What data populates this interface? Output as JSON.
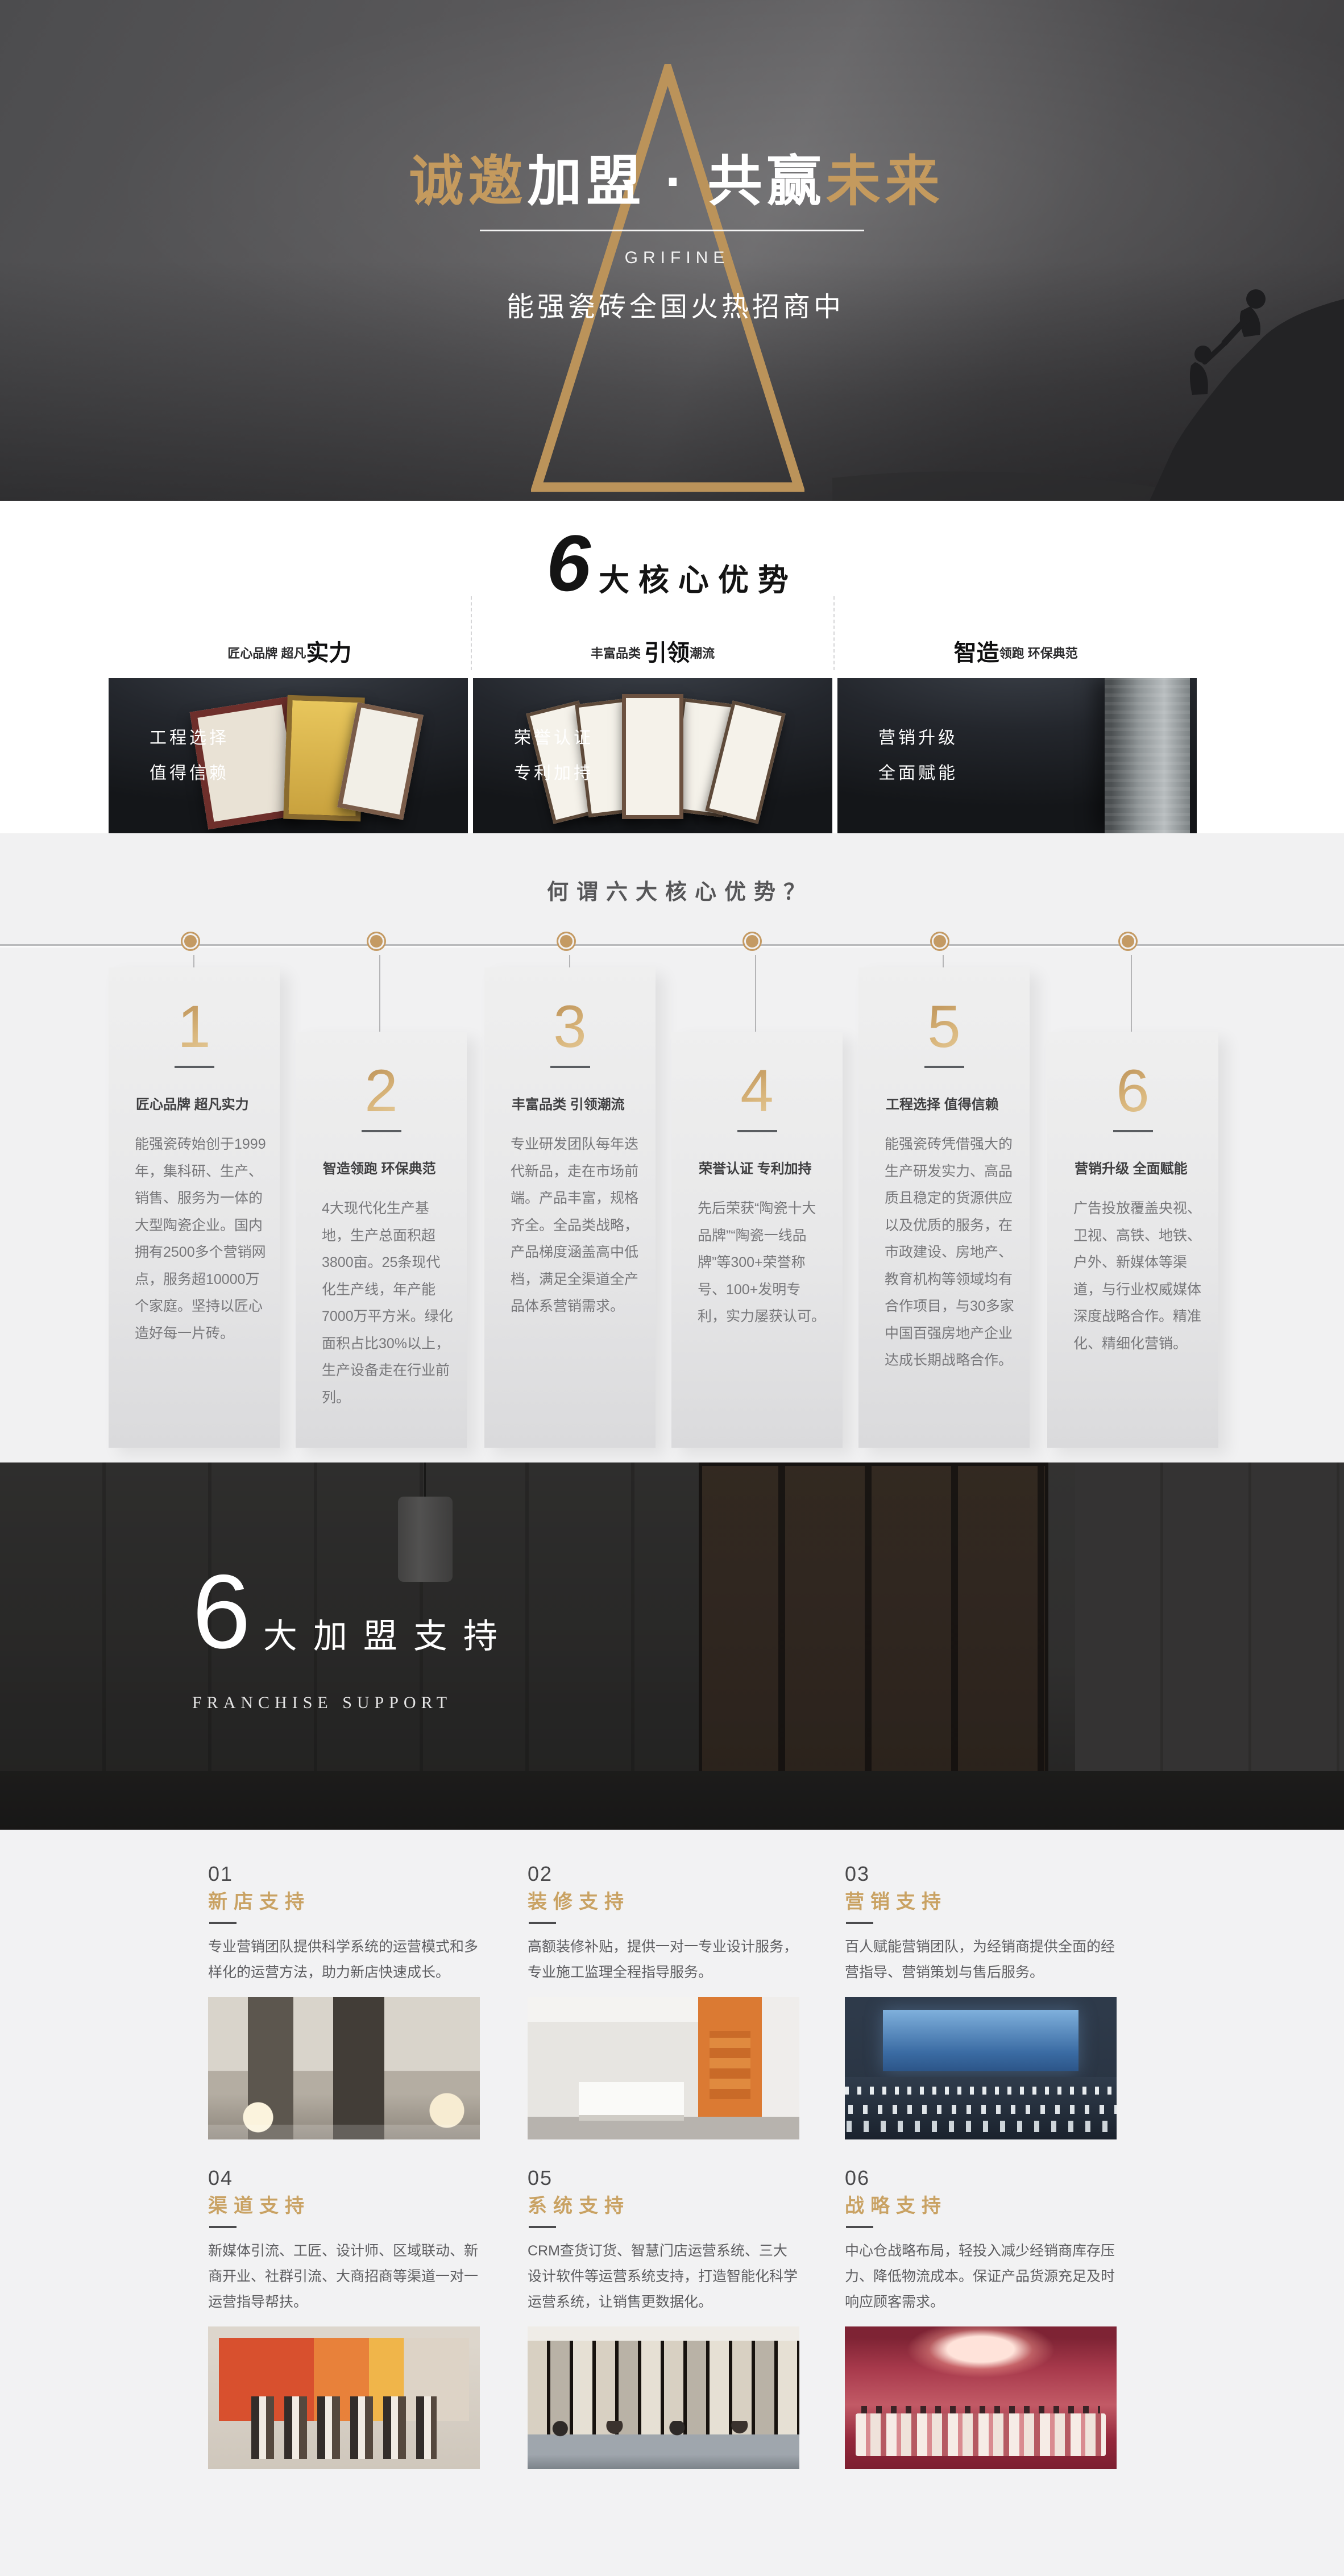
{
  "colors": {
    "accent_gold": "#c49a5e",
    "support_title_gold": "#c9a263",
    "dark_text": "#3f3f41",
    "muted_text": "#77777a",
    "white": "#ffffff"
  },
  "hero": {
    "title_gold_left": "诚邀",
    "title_white_mid": "加盟 · 共赢",
    "title_gold_right": "未来",
    "brand": "GRIFINE",
    "subtitle": "能强瓷砖全国火热招商中"
  },
  "core": {
    "heading_number": "6",
    "heading_text": "大核心优势",
    "features": [
      {
        "pre": "匠心品牌 超凡",
        "big": "实力",
        "post": ""
      },
      {
        "pre": "丰富品类 ",
        "big": "引领",
        "post": "潮流"
      },
      {
        "pre": "",
        "big": "智造",
        "post": "领跑 环保典范"
      }
    ],
    "dark_cards": [
      {
        "line1": "工程选择",
        "line2": "值得信赖"
      },
      {
        "line1": "荣誉认证",
        "line2": "专利加持"
      },
      {
        "line1": "营销升级",
        "line2": "全面赋能"
      }
    ]
  },
  "advantages": {
    "heading": "何谓六大核心优势？",
    "items": [
      {
        "num": "1",
        "title": "匠心品牌 超凡实力",
        "desc": "能强瓷砖始创于1999年，集科研、生产、销售、服务为一体的大型陶瓷企业。国内拥有2500多个营销网点，服务超10000万个家庭。坚持以匠心造好每一片砖。"
      },
      {
        "num": "2",
        "title": "智造领跑 环保典范",
        "desc": "4大现代化生产基地，生产总面积超3800亩。25条现代化生产线，年产能7000万平方米。绿化面积占比30%以上，生产设备走在行业前列。"
      },
      {
        "num": "3",
        "title": "丰富品类 引领潮流",
        "desc": "专业研发团队每年迭代新品，走在市场前端。产品丰富，规格齐全。全品类战略，产品梯度涵盖高中低档，满足全渠道全产品体系营销需求。"
      },
      {
        "num": "4",
        "title": "荣誉认证 专利加持",
        "desc": "先后荣获“陶瓷十大品牌”“陶瓷一线品牌”等300+荣誉称号、100+发明专利，实力屡获认可。"
      },
      {
        "num": "5",
        "title": "工程选择 值得信赖",
        "desc": "能强瓷砖凭借强大的生产研发实力、高品质且稳定的货源供应以及优质的服务，在市政建设、房地产、教育机构等领域均有合作项目，与30多家中国百强房地产企业达成长期战略合作。"
      },
      {
        "num": "6",
        "title": "营销升级 全面赋能",
        "desc": "广告投放覆盖央视、卫视、高铁、地铁、户外、新媒体等渠道，与行业权威媒体深度战略合作。精准化、精细化营销。"
      }
    ]
  },
  "franchise": {
    "number": "6",
    "text": "大加盟支持",
    "subtitle": "FRANCHISE SUPPORT"
  },
  "supports": {
    "items": [
      {
        "num": "01",
        "title": "新店支持",
        "desc": "专业营销团队提供科学系统的运营模式和多样化的运营方法，助力新店快速成长。"
      },
      {
        "num": "02",
        "title": "装修支持",
        "desc": "高额装修补贴，提供一对一专业设计服务，专业施工监理全程指导服务。"
      },
      {
        "num": "03",
        "title": "营销支持",
        "desc": "百人赋能营销团队，为经销商提供全面的经营指导、营销策划与售后服务。"
      },
      {
        "num": "04",
        "title": "渠道支持",
        "desc": "新媒体引流、工匠、设计师、区域联动、新商开业、社群引流、大商招商等渠道一对一运营指导帮扶。"
      },
      {
        "num": "05",
        "title": "系统支持",
        "desc": "CRM查货订货、智慧门店运营系统、三大设计软件等运营系统支持，打造智能化科学运营系统，让销售更数据化。"
      },
      {
        "num": "06",
        "title": "战略支持",
        "desc": "中心仓战略布局，轻投入减少经销商库存压力、降低物流成本。保证产品货源充足及时响应顾客需求。"
      }
    ]
  }
}
